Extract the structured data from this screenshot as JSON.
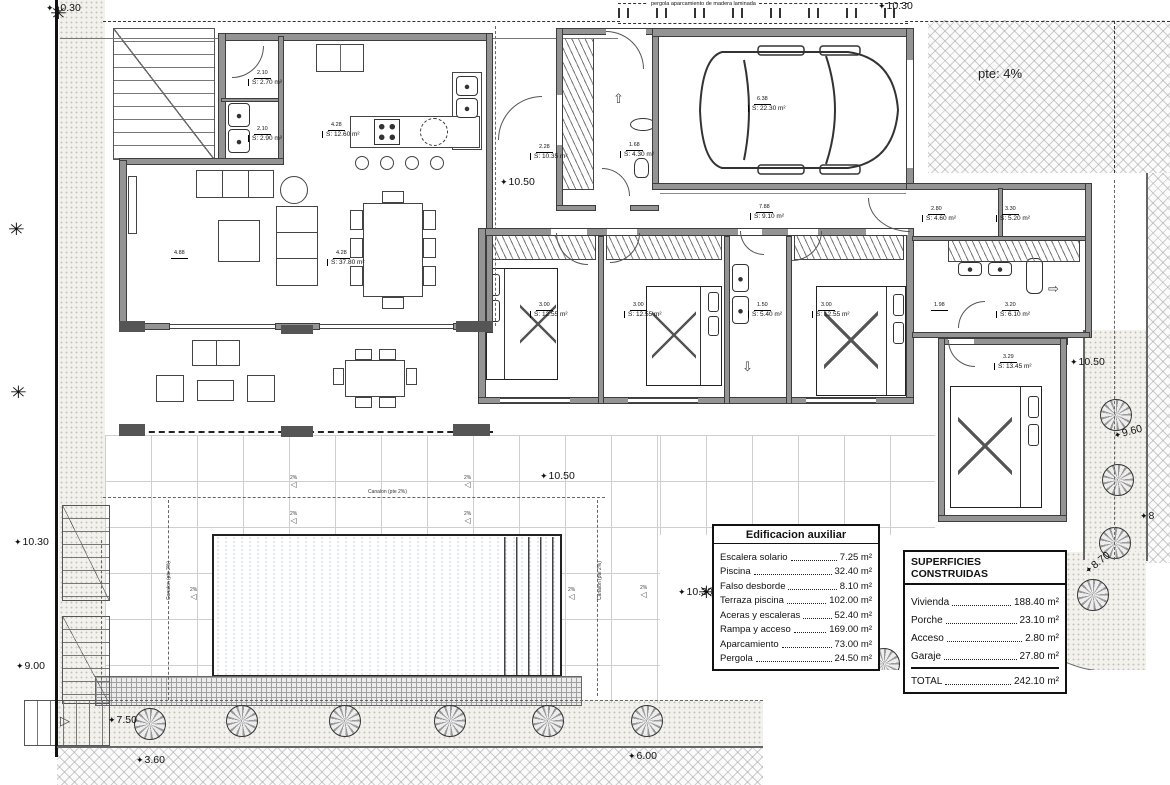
{
  "site": {
    "pergola_note": "pergola aparcamiento de madera laminada",
    "slope_note": "pte: 4%",
    "canalon": "Canalon (pte 2%)",
    "slope_pct": "2%"
  },
  "icons": {
    "star": "✦",
    "slope_arrow": "◁",
    "up_arrow": "⇧",
    "right_arrow": "⇨",
    "down_arrow": "⇩",
    "stair_arrow": "▷",
    "palm": "✳"
  },
  "room_labels": [
    {
      "dim": "2.10",
      "area": "S: 2.70 m²",
      "x": 248,
      "y": 62
    },
    {
      "dim": "2.10",
      "area": "S: 2.90 m²",
      "x": 248,
      "y": 118
    },
    {
      "dim": "4.28",
      "area": "S: 12.60 m²",
      "x": 322,
      "y": 114
    },
    {
      "dim": "4.88",
      "area": "",
      "x": 165,
      "y": 242
    },
    {
      "dim": "4.28",
      "area": "S: 37.80 m²",
      "x": 327,
      "y": 242
    },
    {
      "dim": "2.28",
      "area": "S: 10.35 m²",
      "x": 530,
      "y": 136
    },
    {
      "dim": "1.68",
      "area": "S: 4.30 m²",
      "x": 620,
      "y": 134
    },
    {
      "dim": "6.38",
      "area": "S: 22.30 m²",
      "x": 748,
      "y": 88
    },
    {
      "dim": "7.88",
      "area": "S: 9.10 m²",
      "x": 750,
      "y": 196
    },
    {
      "dim": "3.00",
      "area": "S: 12.55 m²",
      "x": 530,
      "y": 294
    },
    {
      "dim": "3.00",
      "area": "S: 12.55 m²",
      "x": 624,
      "y": 294
    },
    {
      "dim": "1.50",
      "area": "S: 5.40 m²",
      "x": 748,
      "y": 294
    },
    {
      "dim": "3.00",
      "area": "S: 12.55 m²",
      "x": 812,
      "y": 294
    },
    {
      "dim": "2.80",
      "area": "S: 4.60 m²",
      "x": 922,
      "y": 198
    },
    {
      "dim": "3.30",
      "area": "S: 5.20 m²",
      "x": 996,
      "y": 198
    },
    {
      "dim": "1.98",
      "area": "",
      "x": 925,
      "y": 294
    },
    {
      "dim": "3.20",
      "area": "S: 6.10 m²",
      "x": 996,
      "y": 294
    },
    {
      "dim": "3.29",
      "area": "S: 13.45 m²",
      "x": 994,
      "y": 346
    }
  ],
  "dim_labels": [
    {
      "text": "10.30",
      "x": 46,
      "y": 2
    },
    {
      "text": "10.30",
      "x": 878,
      "y": 0
    },
    {
      "text": "10.50",
      "x": 500,
      "y": 176
    },
    {
      "text": "10.50",
      "x": 540,
      "y": 470
    },
    {
      "text": "10.50",
      "x": 1070,
      "y": 356
    },
    {
      "text": "9.60",
      "x": 1114,
      "y": 430,
      "rot": -15
    },
    {
      "text": "8",
      "x": 1140,
      "y": 510
    },
    {
      "text": "8.70",
      "x": 1086,
      "y": 566,
      "rot": -38
    },
    {
      "text": "10.30",
      "x": 678,
      "y": 586
    },
    {
      "text": "10.30",
      "x": 14,
      "y": 536
    },
    {
      "text": "9.00",
      "x": 16,
      "y": 660
    },
    {
      "text": "7.50",
      "x": 108,
      "y": 714
    },
    {
      "text": "3.60",
      "x": 136,
      "y": 754
    },
    {
      "text": "6.00",
      "x": 628,
      "y": 750
    },
    {
      "text": "0.10",
      "x": 906,
      "y": 653
    }
  ],
  "arrows": [
    {
      "name": "entrance-up-arrow",
      "icon": "up_arrow",
      "x": 613,
      "y": 92
    },
    {
      "name": "closet-right-arrow",
      "icon": "right_arrow",
      "x": 1048,
      "y": 282
    },
    {
      "name": "bath-down-arrow",
      "icon": "down_arrow",
      "x": 742,
      "y": 360
    },
    {
      "name": "stair-right-arrow",
      "icon": "stair_arrow",
      "x": 60,
      "y": 714
    }
  ],
  "slopes": [
    {
      "x": 290,
      "y": 476
    },
    {
      "x": 464,
      "y": 476
    },
    {
      "x": 290,
      "y": 512
    },
    {
      "x": 464,
      "y": 512
    },
    {
      "x": 190,
      "y": 588
    },
    {
      "x": 568,
      "y": 588
    },
    {
      "x": 640,
      "y": 586
    }
  ],
  "canalons": [
    {
      "x": 368,
      "y": 489,
      "rot": 0
    },
    {
      "x": 166,
      "y": 600,
      "rot": -90
    },
    {
      "x": 597,
      "y": 600,
      "rot": -90
    }
  ],
  "palms": [
    {
      "x": 50,
      "y": 4
    },
    {
      "x": 8,
      "y": 220
    },
    {
      "x": 10,
      "y": 383
    },
    {
      "x": 698,
      "y": 583
    },
    {
      "x": 742,
      "y": 628
    }
  ],
  "trees": [
    {
      "x": 150,
      "y": 724
    },
    {
      "x": 242,
      "y": 721
    },
    {
      "x": 345,
      "y": 721
    },
    {
      "x": 450,
      "y": 721
    },
    {
      "x": 548,
      "y": 721
    },
    {
      "x": 647,
      "y": 721
    },
    {
      "x": 884,
      "y": 664
    },
    {
      "x": 970,
      "y": 658
    },
    {
      "x": 1051,
      "y": 628
    },
    {
      "x": 1093,
      "y": 595
    },
    {
      "x": 1115,
      "y": 543
    },
    {
      "x": 1118,
      "y": 480
    },
    {
      "x": 1116,
      "y": 415
    }
  ],
  "tables": {
    "aux": {
      "title": "Edificacion auxiliar",
      "rows": [
        {
          "label": "Escalera solario",
          "value": "7.25 m²"
        },
        {
          "label": "Piscina",
          "value": "32.40 m²"
        },
        {
          "label": "Falso desborde",
          "value": "8.10 m²"
        },
        {
          "label": "Terraza piscina",
          "value": "102.00 m²"
        },
        {
          "label": "Aceras y escaleras",
          "value": "52.40 m²"
        },
        {
          "label": "Rampa y acceso",
          "value": "169.00 m²"
        },
        {
          "label": "Aparcamiento",
          "value": "73.00 m²"
        },
        {
          "label": "Pergola",
          "value": "24.50 m²"
        }
      ]
    },
    "built": {
      "title": "SUPERFICIES CONSTRUIDAS",
      "rows": [
        {
          "label": "Vivienda",
          "value": "188.40 m²"
        },
        {
          "label": "Porche",
          "value": "23.10 m²"
        },
        {
          "label": "Acceso",
          "value": "2.80 m²"
        },
        {
          "label": "Garaje",
          "value": "27.80 m²"
        }
      ],
      "total": {
        "label": "TOTAL",
        "value": "242.10 m²"
      }
    }
  }
}
